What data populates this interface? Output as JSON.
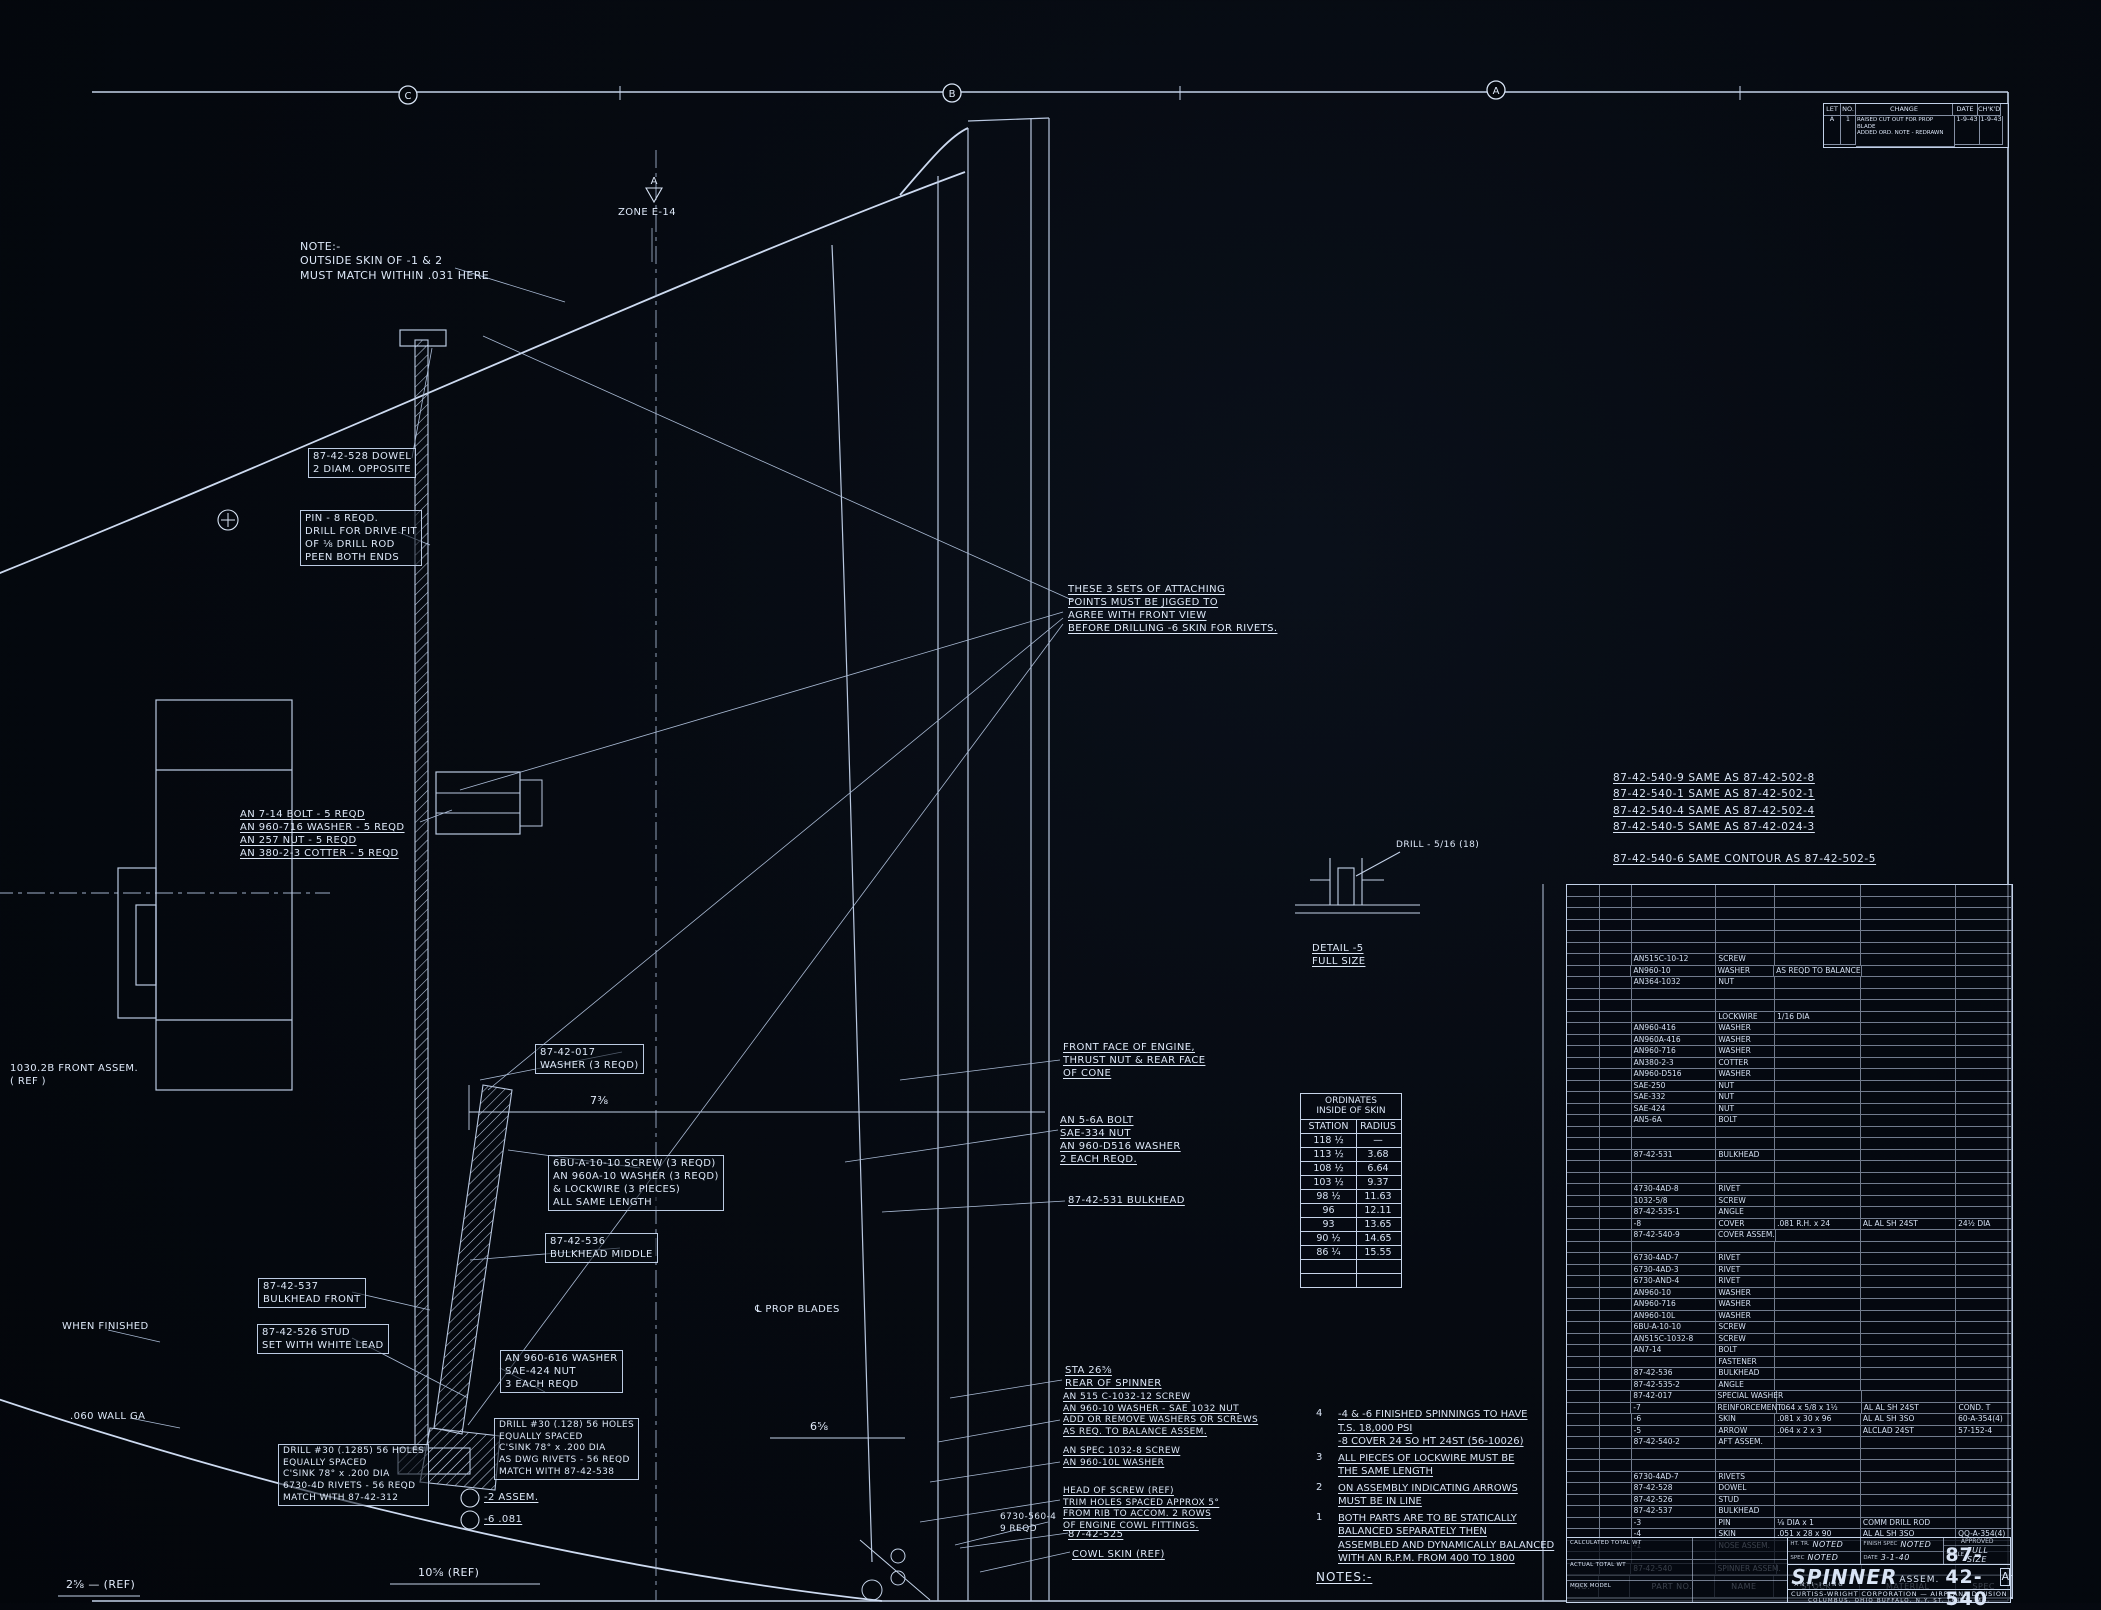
{
  "sheet": {
    "zone_markers": [
      "C",
      "B",
      "A"
    ],
    "zone_label": "ZONE E-14",
    "apex_flag": "A"
  },
  "revision_block": {
    "headers": [
      "LET",
      "NO.",
      "CHANGE",
      "DATE",
      "CH'K'D"
    ],
    "row": {
      "let": "A",
      "no": "1",
      "change": "RAISED CUT OUT FOR PROP BLADE\nADDED ORD. NOTE - REDRAWN",
      "date": "1-9-43",
      "chkd": "1-9-43"
    }
  },
  "same_as_notes": "87-42-540-9  SAME AS   87-42-502-8\n87-42-540-1  SAME AS   87-42-502-1\n87-42-540-4  SAME AS   87-42-502-4\n87-42-540-5  SAME AS   87-42-024-3\n\n87-42-540-6   SAME CONTOUR AS 87-42-502-5",
  "ordinates_table": {
    "title": "ORDINATES\nINSIDE OF SKIN",
    "columns": [
      "STATION",
      "RADIUS"
    ],
    "rows": [
      [
        "118 ½",
        "—"
      ],
      [
        "113 ½",
        "3.68"
      ],
      [
        "108 ½",
        "6.64"
      ],
      [
        "103 ½",
        "9.37"
      ],
      [
        "98 ½",
        "11.63"
      ],
      [
        "96",
        "12.11"
      ],
      [
        "93",
        "13.65"
      ],
      [
        "90 ½",
        "14.65"
      ],
      [
        "86 ¼",
        "15.55"
      ],
      [
        "",
        ""
      ],
      [
        "",
        ""
      ]
    ]
  },
  "notes": {
    "heading": "NOTES:-",
    "items": [
      {
        "n": "4",
        "text": "-4 & -6 FINISHED SPINNINGS TO HAVE\nT.S. 18,000 PSI\n-8 COVER 24 SO HT 24ST (56-10026)"
      },
      {
        "n": "3",
        "text": "ALL PIECES OF LOCKWIRE MUST BE\nTHE SAME LENGTH"
      },
      {
        "n": "2",
        "text": "ON ASSEMBLY INDICATING ARROWS\nMUST BE IN LINE"
      },
      {
        "n": "1",
        "text": "BOTH PARTS ARE TO BE STATICALLY\nBALANCED SEPARATELY THEN\nASSEMBLED AND DYNAMICALLY BALANCED\nWITH AN R.P.M. FROM 400 TO 1800"
      }
    ]
  },
  "parts_table": {
    "headers": [
      "NO.",
      "",
      "PART NO.",
      "NAME",
      "STOCK",
      "MATERIAL",
      "SPEC"
    ],
    "rows": [
      [],
      [],
      [],
      [],
      [],
      [],
      [
        "AN515C-10-12",
        "SCREW",
        "",
        "",
        ""
      ],
      [
        "AN960-10",
        "WASHER",
        "AS REQD TO BALANCE",
        "",
        ""
      ],
      [
        "AN364-1032",
        "NUT",
        "",
        "",
        ""
      ],
      [],
      [],
      [
        "",
        "LOCKWIRE",
        "1/16 DIA",
        "",
        ""
      ],
      [
        "AN960-416",
        "WASHER",
        "",
        "",
        ""
      ],
      [
        "AN960A-416",
        "WASHER",
        "",
        "",
        ""
      ],
      [
        "AN960-716",
        "WASHER",
        "",
        "",
        ""
      ],
      [
        "AN380-2-3",
        "COTTER",
        "",
        "",
        ""
      ],
      [
        "AN960-D516",
        "WASHER",
        "",
        "",
        ""
      ],
      [
        "SAE-250",
        "NUT",
        "",
        "",
        ""
      ],
      [
        "SAE-332",
        "NUT",
        "",
        "",
        ""
      ],
      [
        "SAE-424",
        "NUT",
        "",
        "",
        ""
      ],
      [
        "AN5-6A",
        "BOLT",
        "",
        "",
        ""
      ],
      [],
      [],
      [
        "87-42-531",
        "BULKHEAD",
        "",
        "",
        ""
      ],
      [],
      [],
      [
        "4730-4AD-8",
        "RIVET",
        "",
        "",
        ""
      ],
      [
        "1032-5/8",
        "SCREW",
        "",
        "",
        ""
      ],
      [
        "87-42-535-1",
        "ANGLE",
        "",
        "",
        ""
      ],
      [
        "-8",
        "COVER",
        ".081 R.H. x 24",
        "AL AL SH 24ST",
        "24½ DIA"
      ],
      [
        "87-42-540-9",
        "COVER ASSEM.",
        "",
        "",
        ""
      ],
      [],
      [
        "6730-4AD-7",
        "RIVET",
        "",
        "",
        ""
      ],
      [
        "6730-4AD-3",
        "RIVET",
        "",
        "",
        ""
      ],
      [
        "6730-AND-4",
        "RIVET",
        "",
        "",
        ""
      ],
      [
        "AN960-10",
        "WASHER",
        "",
        "",
        ""
      ],
      [
        "AN960-716",
        "WASHER",
        "",
        "",
        ""
      ],
      [
        "AN960-10L",
        "WASHER",
        "",
        "",
        ""
      ],
      [
        "6BU-A-10-10",
        "SCREW",
        "",
        "",
        ""
      ],
      [
        "AN515C-1032-8",
        "SCREW",
        "",
        "",
        ""
      ],
      [
        "AN7-14",
        "BOLT",
        "",
        "",
        ""
      ],
      [
        "",
        "FASTENER",
        "",
        "",
        ""
      ],
      [
        "87-42-536",
        "BULKHEAD",
        "",
        "",
        ""
      ],
      [
        "87-42-535-2",
        "ANGLE",
        "",
        "",
        ""
      ],
      [
        "87-42-017",
        "SPECIAL WASHER",
        "",
        "",
        ""
      ],
      [
        "-7",
        "REINFORCEMENT",
        ".064 x 5/8 x 1½",
        "AL AL SH 24ST",
        "COND. T"
      ],
      [
        "-6",
        "SKIN",
        ".081 x 30 x 96",
        "AL AL SH 3SO",
        "60-A-354(4)"
      ],
      [
        "-5",
        "ARROW",
        ".064 x 2 x 3",
        "ALCLAD 24ST",
        "57-152-4"
      ],
      [
        "87-42-540-2",
        "AFT ASSEM.",
        "",
        "",
        ""
      ],
      [],
      [],
      [
        "6730-4AD-7",
        "RIVETS",
        "",
        "",
        ""
      ],
      [
        "87-42-528",
        "DOWEL",
        "",
        "",
        ""
      ],
      [
        "87-42-526",
        "STUD",
        "",
        "",
        ""
      ],
      [
        "87-42-537",
        "BULKHEAD",
        "",
        "",
        ""
      ],
      [
        "-3",
        "PIN",
        "⅛ DIA x 1",
        "COMM DRILL ROD",
        ""
      ],
      [
        "-4",
        "SKIN",
        ".051 x 28 x 90",
        "AL AL SH 3SO",
        "QQ-A-354(4)"
      ],
      [
        "-1",
        "NOSE ASSEM.",
        "",
        "",
        ""
      ],
      [],
      [
        "87-42-540",
        "SPINNER ASSEM.",
        "",
        "",
        ""
      ]
    ]
  },
  "title_block": {
    "wt_rows": [
      "CALCULATED TOTAL WT",
      "ACTUAL TOTAL WT",
      "MOCK MODEL"
    ],
    "heat_label": "HT. TR.",
    "heat": "NOTED",
    "spec_label": "SPEC",
    "spec": "NOTED",
    "finish_label": "FINISH SPEC",
    "finish": "NOTED",
    "date_label": "DATE",
    "date": "3-1-40",
    "approved_label": "APPROVED",
    "scale_label": "SCALE",
    "scale": "FULL SIZE",
    "title": "SPINNER",
    "title_suffix": "ASSEM.",
    "subtitle": "ANTI-ICING",
    "number": "87-42-540",
    "rev": "A",
    "company": "CURTISS-WRIGHT CORPORATION — AIRPLANE DIVISION",
    "company2": "COLUMBUS, OHIO      BUFFALO, N.Y.      ST. LOUIS, MO."
  },
  "callouts": {
    "note_outside_skin": "NOTE:-\nOUTSIDE SKIN OF -1 & 2\nMUST MATCH WITHIN .031 HERE",
    "dowel": "87-42-528 DOWEL\n2 DIAM. OPPOSITE",
    "pin": "PIN - 8 REQD.\nDRILL FOR DRIVE FIT\nOF ⅛ DRILL ROD\nPEEN BOTH ENDS",
    "bolt_stack": "AN 7-14 BOLT - 5 REQD\nAN 960-716 WASHER - 5 REQD\nAN 257 NUT - 5 REQD\nAN 380-2-3 COTTER - 5 REQD",
    "front_assem_ref": "1030.2B FRONT ASSEM.\n( REF )",
    "when_finished": "WHEN FINISHED",
    "wall_ga": ".060 WALL GA",
    "washer_017": "87-42-017\nWASHER (3 REQD)",
    "screw_cluster": "6BU-A-10-10 SCREW  (3 REQD)\nAN 960A-10 WASHER  (3 REQD)\n& LOCKWIRE  (3 PIECES)\nALL SAME LENGTH",
    "bulkhead_middle": "87-42-536\nBULKHEAD MIDDLE",
    "bulkhead_front": "87-42-537\nBULKHEAD FRONT",
    "stud": "87-42-526 STUD\nSET WITH WHITE LEAD",
    "washer_nut_3each": "AN 960-616 WASHER\nSAE-424 NUT\n3 EACH REQD",
    "drill_note_left": "DRILL #30 (.1285) 56 HOLES\nEQUALLY SPACED\nC'SINK 78° x .200 DIA\n6730-4D RIVETS - 56 REQD\nMATCH WITH 87-42-312",
    "drill_note_right": "DRILL #30 (.128) 56 HOLES\nEQUALLY SPACED\nC'SINK 78° x .200 DIA\nAS DWG RIVETS - 56 REQD\nMATCH WITH 87-42-538",
    "balloon_2": "-2   ASSEM.",
    "balloon_6": "-6   .081",
    "prop_blades": "℄ PROP BLADES",
    "attaching_points": "THESE 3 SETS OF ATTACHING\nPOINTS MUST BE JIGGED TO\nAGREE WITH FRONT VIEW\nBEFORE DRILLING -6 SKIN FOR RIVETS.",
    "front_face": "FRONT FACE OF ENGINE,\nTHRUST NUT & REAR FACE\nOF CONE",
    "an5_stack": "AN 5-6A BOLT\nSAE-334 NUT\nAN 960-D516 WASHER\n2 EACH REQD.",
    "bulkhead_531": "87-42-531 BULKHEAD",
    "sta_block": "STA 26⅝\nREAR OF SPINNER",
    "screw_balance": "AN 515 C-1032-12 SCREW\nAN 960-10 WASHER - SAE 1032 NUT\nADD OR REMOVE WASHERS OR SCREWS\nAS REQ. TO BALANCE ASSEM.",
    "screw_spec": "AN SPEC 1032-8 SCREW\nAN 960-10L WASHER",
    "trim_note": "HEAD OF SCREW (REF)\nTRIM HOLES SPACED APPROX 5°\nFROM RIB TO ACCOM. 2 ROWS\nOF ENGINE COWL FITTINGS.",
    "rivets_560": "6730-560-4\n9 REQD",
    "part_525": "87-42-525",
    "cowl_skin": "COWL SKIN (REF)",
    "detail5": "DETAIL -5\nFULL SIZE",
    "drill_detail": "DRILL - 5/16 (18)",
    "zone_label": "ZONE E-14"
  },
  "dimensions": {
    "d1": "7⅜",
    "d2": "6⅝",
    "d3": "10⅝ (REF)",
    "d4": "2⅝ — (REF)"
  }
}
